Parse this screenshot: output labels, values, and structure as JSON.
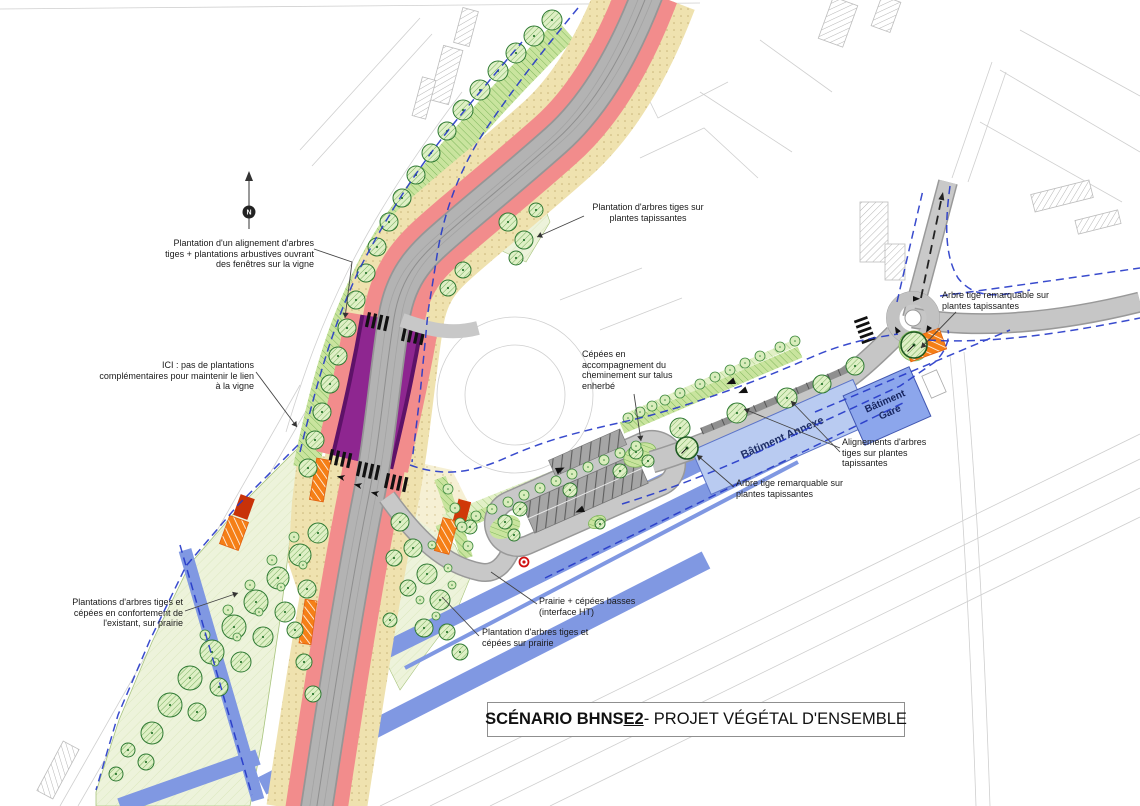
{
  "title": {
    "part1": "SCÉNARIO BHNS ",
    "part2": "E2",
    "part3": " - PROJET VÉGÉTAL D'ENSEMBLE"
  },
  "north": {
    "label": "N"
  },
  "buildings": {
    "annexe": "Bâtiment Annexe",
    "gare_line1": "Bâtiment",
    "gare_line2": "Gare"
  },
  "annotations": [
    {
      "id": "alignement-vigne",
      "text": "Plantation d'un alignement d'arbres tiges + plantations arbustives ouvrant des fenêtres sur la vigne",
      "leaders": [
        {
          "pts": [
            [
              314,
              249
            ],
            [
              352,
              262
            ],
            [
              345,
              318
            ]
          ],
          "arrow": true
        }
      ]
    },
    {
      "id": "ici-pas-plantations",
      "text": "ICI : pas de plantations complémentaires pour maintenir le lien à la vigne",
      "leaders": [
        {
          "pts": [
            [
              256,
              372
            ],
            [
              297,
              427
            ]
          ],
          "arrow": true
        }
      ]
    },
    {
      "id": "confortement-prairie",
      "text": "Plantations d'arbres tiges et cépées en confortement de l'existant, sur prairie",
      "leaders": [
        {
          "pts": [
            [
              185,
              611
            ],
            [
              238,
              593
            ]
          ],
          "arrow": true
        }
      ]
    },
    {
      "id": "arbres-tapissantes-nord",
      "text": "Plantation d'arbres tiges sur plantes tapissantes",
      "leaders": [
        {
          "pts": [
            [
              584,
              216
            ],
            [
              537,
              237
            ]
          ],
          "arrow": true
        }
      ]
    },
    {
      "id": "cepees-cheminement",
      "text": "Cépées en accompagnement du cheminement sur talus enherbé",
      "leaders": [
        {
          "pts": [
            [
              634,
              394
            ],
            [
              641,
              441
            ]
          ],
          "arrow": true
        }
      ]
    },
    {
      "id": "arbre-remarquable-giratoire",
      "text": "Arbre tige remarquable sur plantes tapissantes",
      "leaders": [
        {
          "pts": [
            [
              956,
              312
            ],
            [
              921,
              348
            ]
          ],
          "arrow": true
        }
      ]
    },
    {
      "id": "alignements-gare",
      "text": "Alignements d'arbres tiges sur plantes tapissantes",
      "leaders": [
        {
          "pts": [
            [
              840,
              448
            ],
            [
              744,
              409
            ]
          ],
          "arrow": true
        },
        {
          "pts": [
            [
              840,
              452
            ],
            [
              791,
              401
            ]
          ],
          "arrow": true
        }
      ]
    },
    {
      "id": "arbre-remarquable-parvis",
      "text": "Arbre tige remarquable sur plantes tapissantes",
      "leaders": [
        {
          "pts": [
            [
              734,
              487
            ],
            [
              697,
              455
            ]
          ],
          "arrow": true
        }
      ]
    },
    {
      "id": "prairie-cepees-basses",
      "text": "Prairie + cépées basses (interface HT)",
      "leaders": [
        {
          "pts": [
            [
              537,
              604
            ],
            [
              491,
              572
            ]
          ],
          "arrow": false
        }
      ]
    },
    {
      "id": "plantation-sur-prairie",
      "text": "Plantation d'arbres tiges et cépées sur prairie",
      "leaders": [
        {
          "pts": [
            [
              479,
              636
            ],
            [
              442,
              597
            ]
          ],
          "arrow": false
        }
      ]
    }
  ],
  "map": {
    "colors": {
      "bhns_lane": "#F28C8C",
      "roadway": "#B3B3B3",
      "platform_purple": "#8E2690",
      "sidewalk_tan": "#EFE2AF",
      "grass_green": "#C9E49E",
      "prairie": "#EDF3DB",
      "tree_green": "#2F7A33",
      "rail_platform": "#8098E2",
      "boundary_blue": "#2438C8",
      "building_annexe": "#B9CBF1",
      "building_gare": "#8CA6EC",
      "orange_works": "#F57F17",
      "red_marker": "#D01010"
    },
    "trees": {
      "tiges": [
        [
          308,
          468,
          9
        ],
        [
          315,
          440,
          9
        ],
        [
          322,
          412,
          9
        ],
        [
          330,
          384,
          9
        ],
        [
          338,
          356,
          9
        ],
        [
          347,
          328,
          9
        ],
        [
          356,
          300,
          9
        ],
        [
          366,
          273,
          9
        ],
        [
          377,
          247,
          9
        ],
        [
          389,
          222,
          9
        ],
        [
          402,
          198,
          9
        ],
        [
          416,
          175,
          9
        ],
        [
          431,
          153,
          9
        ],
        [
          447,
          131,
          9
        ],
        [
          463,
          110,
          10
        ],
        [
          480,
          90,
          10
        ],
        [
          498,
          71,
          10
        ],
        [
          516,
          53,
          10
        ],
        [
          534,
          36,
          10
        ],
        [
          552,
          20,
          10
        ],
        [
          152,
          733,
          11
        ],
        [
          170,
          705,
          12
        ],
        [
          190,
          678,
          12
        ],
        [
          212,
          652,
          12
        ],
        [
          234,
          627,
          12
        ],
        [
          256,
          602,
          12
        ],
        [
          278,
          578,
          11
        ],
        [
          300,
          555,
          11
        ],
        [
          318,
          533,
          10
        ],
        [
          146,
          762,
          8
        ],
        [
          197,
          712,
          9
        ],
        [
          219,
          687,
          9
        ],
        [
          241,
          662,
          10
        ],
        [
          263,
          637,
          10
        ],
        [
          285,
          612,
          10
        ],
        [
          307,
          589,
          9
        ],
        [
          128,
          750,
          7
        ],
        [
          116,
          774,
          7
        ],
        [
          295,
          630,
          8
        ],
        [
          304,
          662,
          8
        ],
        [
          313,
          694,
          8
        ],
        [
          400,
          522,
          9
        ],
        [
          413,
          548,
          9
        ],
        [
          427,
          574,
          10
        ],
        [
          440,
          600,
          10
        ],
        [
          408,
          588,
          8
        ],
        [
          394,
          558,
          8
        ],
        [
          424,
          628,
          9
        ],
        [
          447,
          632,
          8
        ],
        [
          460,
          652,
          8
        ],
        [
          390,
          620,
          7
        ],
        [
          508,
          222,
          9
        ],
        [
          524,
          240,
          9
        ],
        [
          516,
          258,
          7
        ],
        [
          536,
          210,
          7
        ],
        [
          470,
          527,
          7
        ],
        [
          520,
          509,
          7
        ],
        [
          570,
          490,
          7
        ],
        [
          620,
          471,
          7
        ],
        [
          680,
          428,
          10
        ],
        [
          737,
          413,
          10
        ],
        [
          787,
          398,
          10
        ],
        [
          822,
          384,
          9
        ],
        [
          855,
          366,
          9
        ],
        [
          505,
          522,
          7
        ],
        [
          514,
          535,
          6
        ],
        [
          636,
          452,
          7
        ],
        [
          648,
          461,
          6
        ],
        [
          600,
          524,
          5
        ],
        [
          448,
          288,
          8
        ],
        [
          463,
          270,
          8
        ]
      ],
      "cepees": [
        [
          205,
          635,
          5
        ],
        [
          228,
          610,
          5
        ],
        [
          250,
          585,
          5
        ],
        [
          272,
          560,
          5
        ],
        [
          294,
          537,
          5
        ],
        [
          215,
          662,
          4
        ],
        [
          237,
          637,
          4
        ],
        [
          259,
          612,
          4
        ],
        [
          281,
          587,
          4
        ],
        [
          303,
          565,
          4
        ],
        [
          460,
          523,
          5
        ],
        [
          476,
          516,
          5
        ],
        [
          492,
          509,
          5
        ],
        [
          508,
          502,
          5
        ],
        [
          524,
          495,
          5
        ],
        [
          540,
          488,
          5
        ],
        [
          556,
          481,
          5
        ],
        [
          572,
          474,
          5
        ],
        [
          588,
          467,
          5
        ],
        [
          604,
          460,
          5
        ],
        [
          620,
          453,
          5
        ],
        [
          636,
          446,
          5
        ],
        [
          628,
          418,
          5
        ],
        [
          640,
          412,
          5
        ],
        [
          652,
          406,
          5
        ],
        [
          665,
          400,
          5
        ],
        [
          680,
          393,
          5
        ],
        [
          700,
          384,
          5
        ],
        [
          715,
          377,
          5
        ],
        [
          730,
          370,
          5
        ],
        [
          745,
          363,
          5
        ],
        [
          760,
          356,
          5
        ],
        [
          780,
          347,
          5
        ],
        [
          795,
          341,
          5
        ],
        [
          432,
          545,
          4
        ],
        [
          448,
          568,
          4
        ],
        [
          420,
          600,
          4
        ],
        [
          436,
          616,
          4
        ],
        [
          452,
          585,
          4
        ],
        [
          448,
          489,
          5
        ],
        [
          455,
          508,
          5
        ],
        [
          462,
          527,
          5
        ],
        [
          468,
          546,
          5
        ]
      ],
      "remarkable": [
        [
          914,
          345,
          13
        ],
        [
          687,
          448,
          11
        ]
      ]
    },
    "rail_platforms": [
      [
        620,
        502,
        813,
        409,
        15
      ],
      [
        368,
        659,
        800,
        446,
        17
      ],
      [
        405,
        668,
        798,
        462,
        4
      ],
      [
        262,
        786,
        706,
        560,
        19
      ],
      [
        120,
        806,
        258,
        757,
        16
      ],
      [
        185,
        550,
        258,
        800,
        13
      ],
      [
        352,
        688,
        332,
        790,
        10
      ]
    ]
  }
}
